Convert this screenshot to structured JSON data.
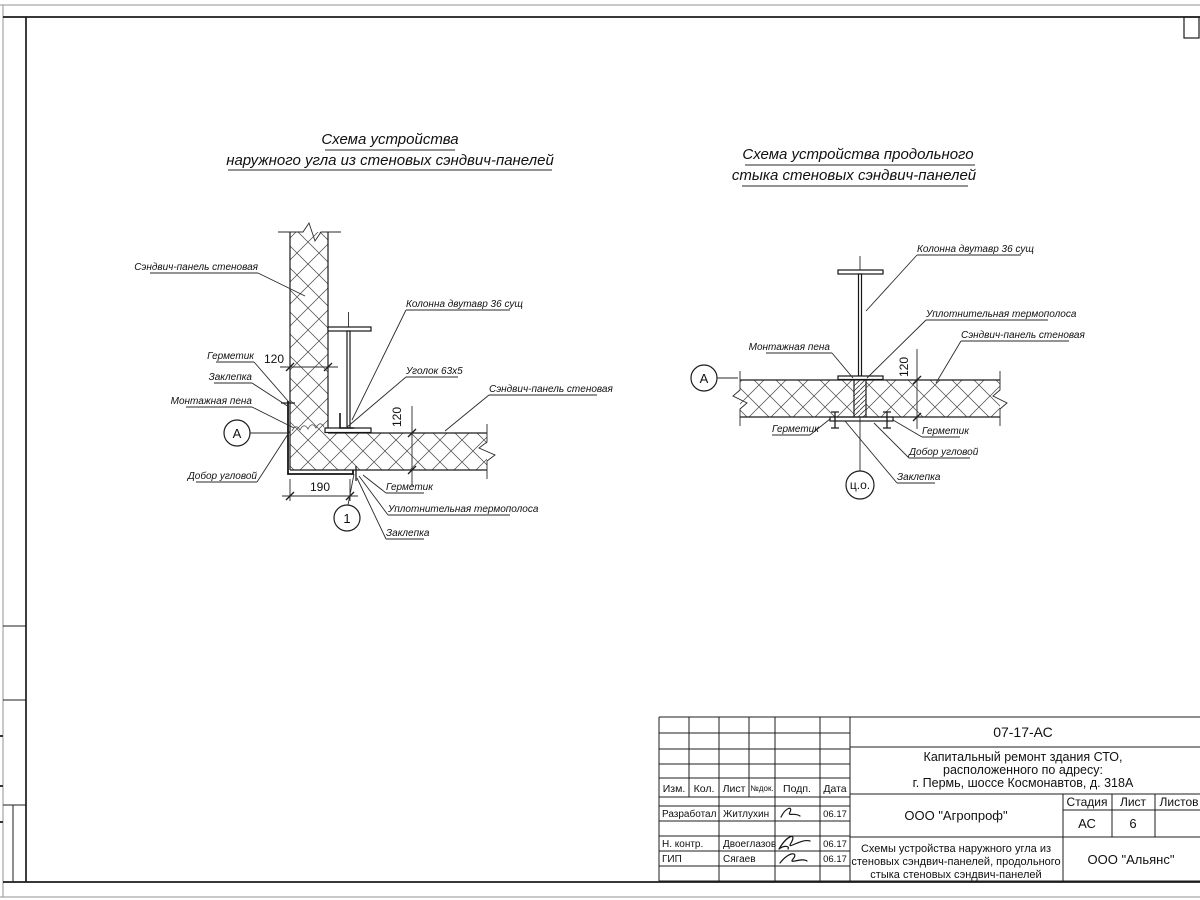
{
  "diagram_left": {
    "title1": "Схема устройства",
    "title2": "наружного угла из стеновых сэндвич-панелей",
    "lbl_panel_top": "Сэндвич-панель стеновая",
    "lbl_column": "Колонна двутавр 36 сущ",
    "lbl_sealant_top": "Герметик",
    "lbl_rivet_top": "Заклепка",
    "lbl_foam": "Монтажная пена",
    "lbl_corner_trim": "Добор угловой",
    "lbl_angle": "Уголок 63х5",
    "lbl_panel_right": "Сэндвич-панель стеновая",
    "lbl_sealant_bottom": "Герметик",
    "lbl_thermo": "Уплотнительная термополоса",
    "lbl_rivet_bottom": "Заклепка",
    "dim_panel_h": "120",
    "dim_panel_v": "120",
    "dim_corner": "190",
    "marker_node": "А",
    "marker_detail": "1"
  },
  "diagram_right": {
    "title1": "Схема устройства продольного",
    "title2": "стыка стеновых сэндвич-панелей",
    "lbl_column": "Колонна двутавр 36 сущ",
    "lbl_thermo": "Уплотнительная термополоса",
    "lbl_panel": "Сэндвич-панель стеновая",
    "lbl_foam": "Монтажная пена",
    "lbl_sealant_left": "Герметик",
    "lbl_sealant_right": "Герметик",
    "lbl_trim": "Добор угловой",
    "lbl_rivet": "Заклепка",
    "dim_panel_v": "120",
    "marker_node": "А",
    "marker_axis": "ц.о."
  },
  "title_block": {
    "doc_number": "07-17-АС",
    "project": [
      "Капитальный ремонт здания СТО,",
      "расположенного по адресу:",
      "г. Пермь, шоссе Космонавтов, д. 318А"
    ],
    "cols": {
      "izm": "Изм.",
      "kol": "Кол.",
      "list": "Лист",
      "ndok": "№док.",
      "podp": "Подп.",
      "data": "Дата"
    },
    "rows": [
      {
        "role": "Разработал",
        "name": "Житлухин",
        "date": "06.17"
      },
      {
        "role": "Н. контр.",
        "name": "Двоеглазов",
        "date": "06.17"
      },
      {
        "role": "ГИП",
        "name": "Сягаев",
        "date": "06.17"
      }
    ],
    "designer_org": "ООО \"Агропроф\"",
    "client_org": "ООО \"Альянс\"",
    "stage_label": "Стадия",
    "sheet_label": "Лист",
    "sheets_label": "Листов",
    "stage_value": "АС",
    "sheet_value": "6",
    "drawing_name": [
      "Схемы устройства наружного угла из",
      "стеновых сэндвич-панелей, продольного",
      "стыка стеновых сэндвич-панелей"
    ]
  }
}
